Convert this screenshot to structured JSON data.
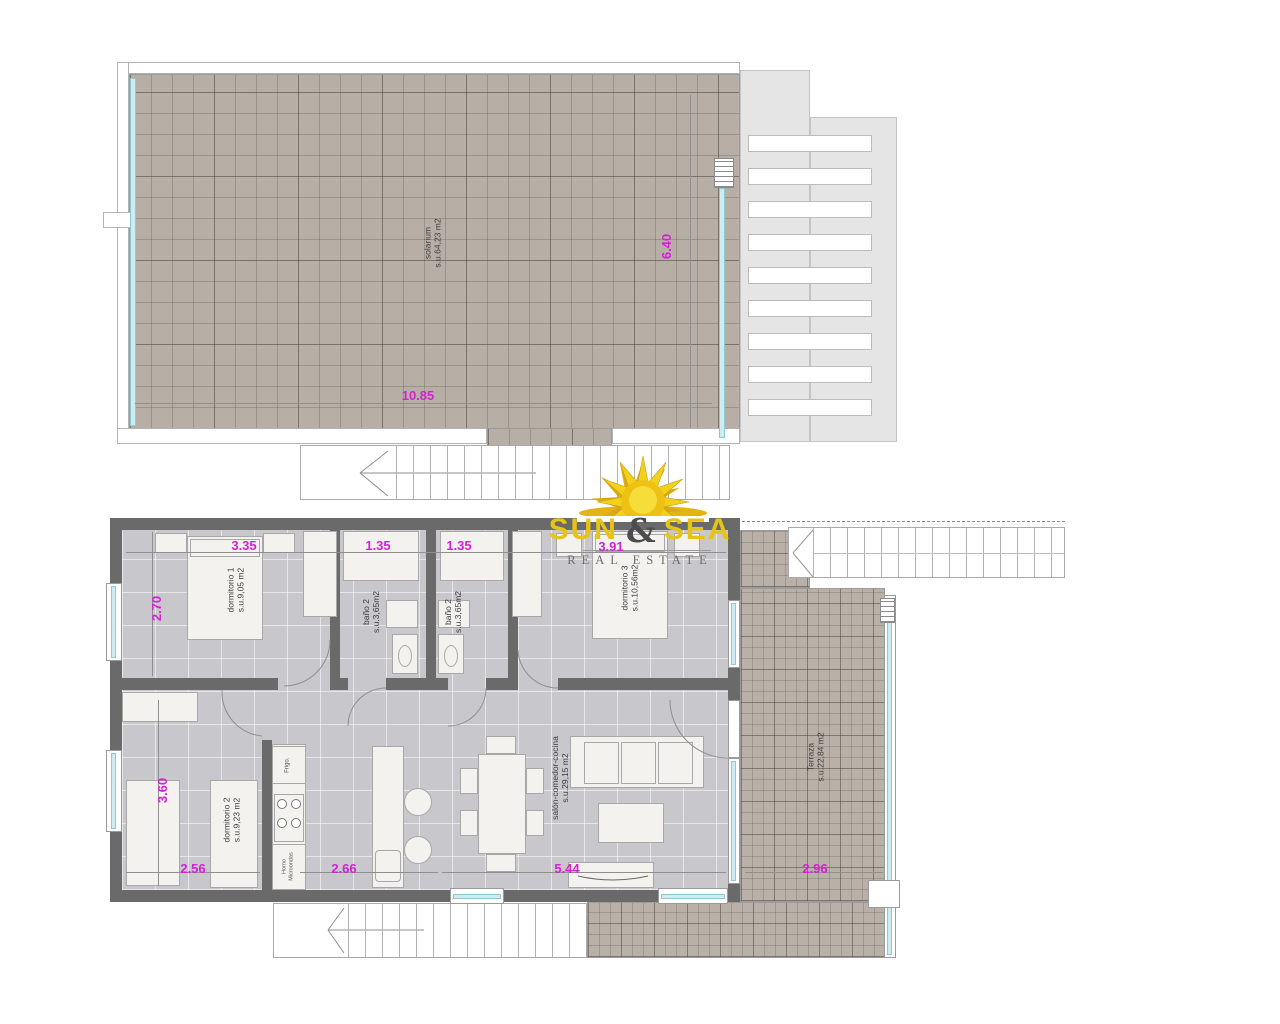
{
  "branding": {
    "word1": "SUN",
    "amp": "&",
    "word2": "SEA",
    "tagline": "REAL ESTATE"
  },
  "colors": {
    "dimension_magenta": "#d321d3",
    "wall_gray": "#6a6a6a",
    "deck_beige": "#b7afa6",
    "floor_gray": "#c7c7cc",
    "glass_cyan": "#cdecf1",
    "logo_yellow": "#e7c314",
    "logo_gray": "#4c4c4c"
  },
  "solarium_plan": {
    "room": {
      "name": "solarium",
      "area": "s.u.64,23 m2"
    },
    "dim_width": "10.85",
    "dim_height": "6.40"
  },
  "apartment_plan": {
    "dormitorio1": {
      "name": "dormitorio 1",
      "area": "s.u.9,05 m2",
      "dim_width": "3.35",
      "dim_height": "2.70"
    },
    "bano_izq": {
      "name": "baño 2",
      "area": "s.u.3,65m2",
      "dim_width": "1.35"
    },
    "bano_der": {
      "name": "baño 2",
      "area": "s.u.3,65m2",
      "dim_width": "1.35"
    },
    "dormitorio3": {
      "name": "dormitorio 3",
      "area": "s.u.10,56m2",
      "dim_width": "3.91"
    },
    "dormitorio2": {
      "name": "dormitorio 2",
      "area": "s.u.9,23 m2",
      "dim_height": "3.60",
      "dim_width": "2.56"
    },
    "cocina": {
      "fridge": "Frigo.",
      "oven_line1": "Horno",
      "oven_line2": "Microondas",
      "dim_width": "2.66"
    },
    "salon": {
      "name": "salón-comedor-cocina",
      "area": "s.u.29,15 m2",
      "dim_width": "5.44"
    },
    "terraza": {
      "name": "Terraza",
      "area": "s.u.22,84 m2",
      "dim_width": "2.96"
    }
  }
}
